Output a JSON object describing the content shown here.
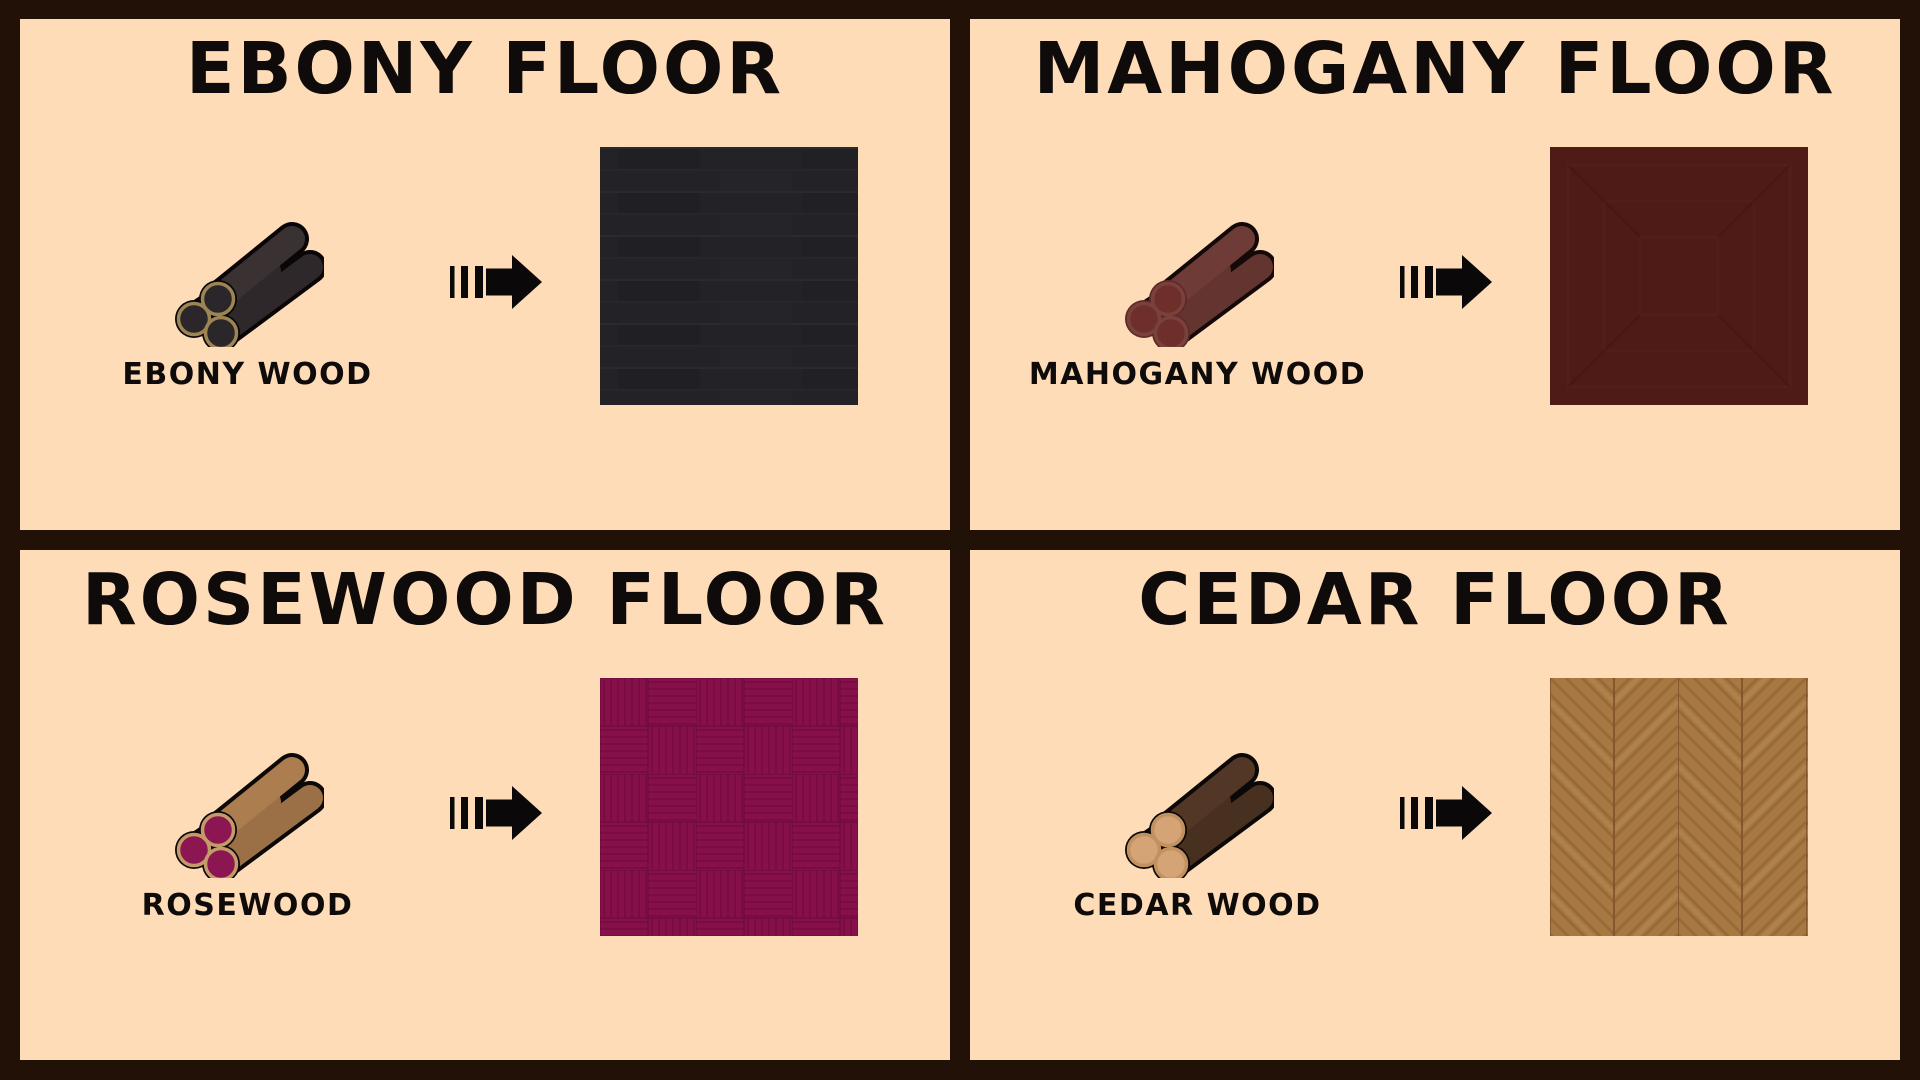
{
  "colors": {
    "frame": "#211107",
    "panel": "#fedcb8",
    "text": "#0e0b0a",
    "arrow": "#0a0808"
  },
  "panels": [
    {
      "id": "ebony",
      "title": "EBONY FLOOR",
      "wood_label": "EBONY WOOD",
      "log": {
        "body": "#3a3133",
        "body2": "#2f282a",
        "end": "#2b2629",
        "ring": "#9c8453",
        "outline": "#0a0607",
        "circle_outline": "#0a0607"
      },
      "floor": {
        "pattern": "planks",
        "base": "#232227",
        "line": "#2c2c31",
        "dark": "#1d1d21"
      }
    },
    {
      "id": "mahogany",
      "title": "MAHOGANY FLOOR",
      "wood_label": "MAHOGANY WOOD",
      "log": {
        "body": "#6f3b36",
        "body2": "#633430",
        "end": "#6e2f2b",
        "ring": "#7a413c",
        "outline": "#140909",
        "circle_outline": "#5d2b27"
      },
      "floor": {
        "pattern": "concentric-squares",
        "base": "#4e1b17",
        "line": "#5c241c",
        "dark": "#431512"
      }
    },
    {
      "id": "rosewood",
      "title": "ROSEWOOD FLOOR",
      "wood_label": "ROSEWOOD",
      "log": {
        "body": "#ab7d4f",
        "body2": "#9c7046",
        "end": "#8c1651",
        "ring": "#c59a69",
        "outline": "#0c0807",
        "circle_outline": "#0c0807"
      },
      "floor": {
        "pattern": "basketweave-parquet",
        "base": "#87104b",
        "line": "#6d0a3c",
        "dark": "#5e0834"
      }
    },
    {
      "id": "cedar",
      "title": "CEDAR FLOOR",
      "wood_label": "CEDAR WOOD",
      "log": {
        "body": "#523626",
        "body2": "#47301f",
        "end": "#d4a376",
        "ring": "#c1925f",
        "outline": "#0c0807",
        "circle_outline": "#0c0807"
      },
      "floor": {
        "pattern": "chevron-herringbone",
        "base": "#a87843",
        "line": "#8a5f33",
        "dark": "#7a5027",
        "light": "#bb9057"
      }
    }
  ]
}
